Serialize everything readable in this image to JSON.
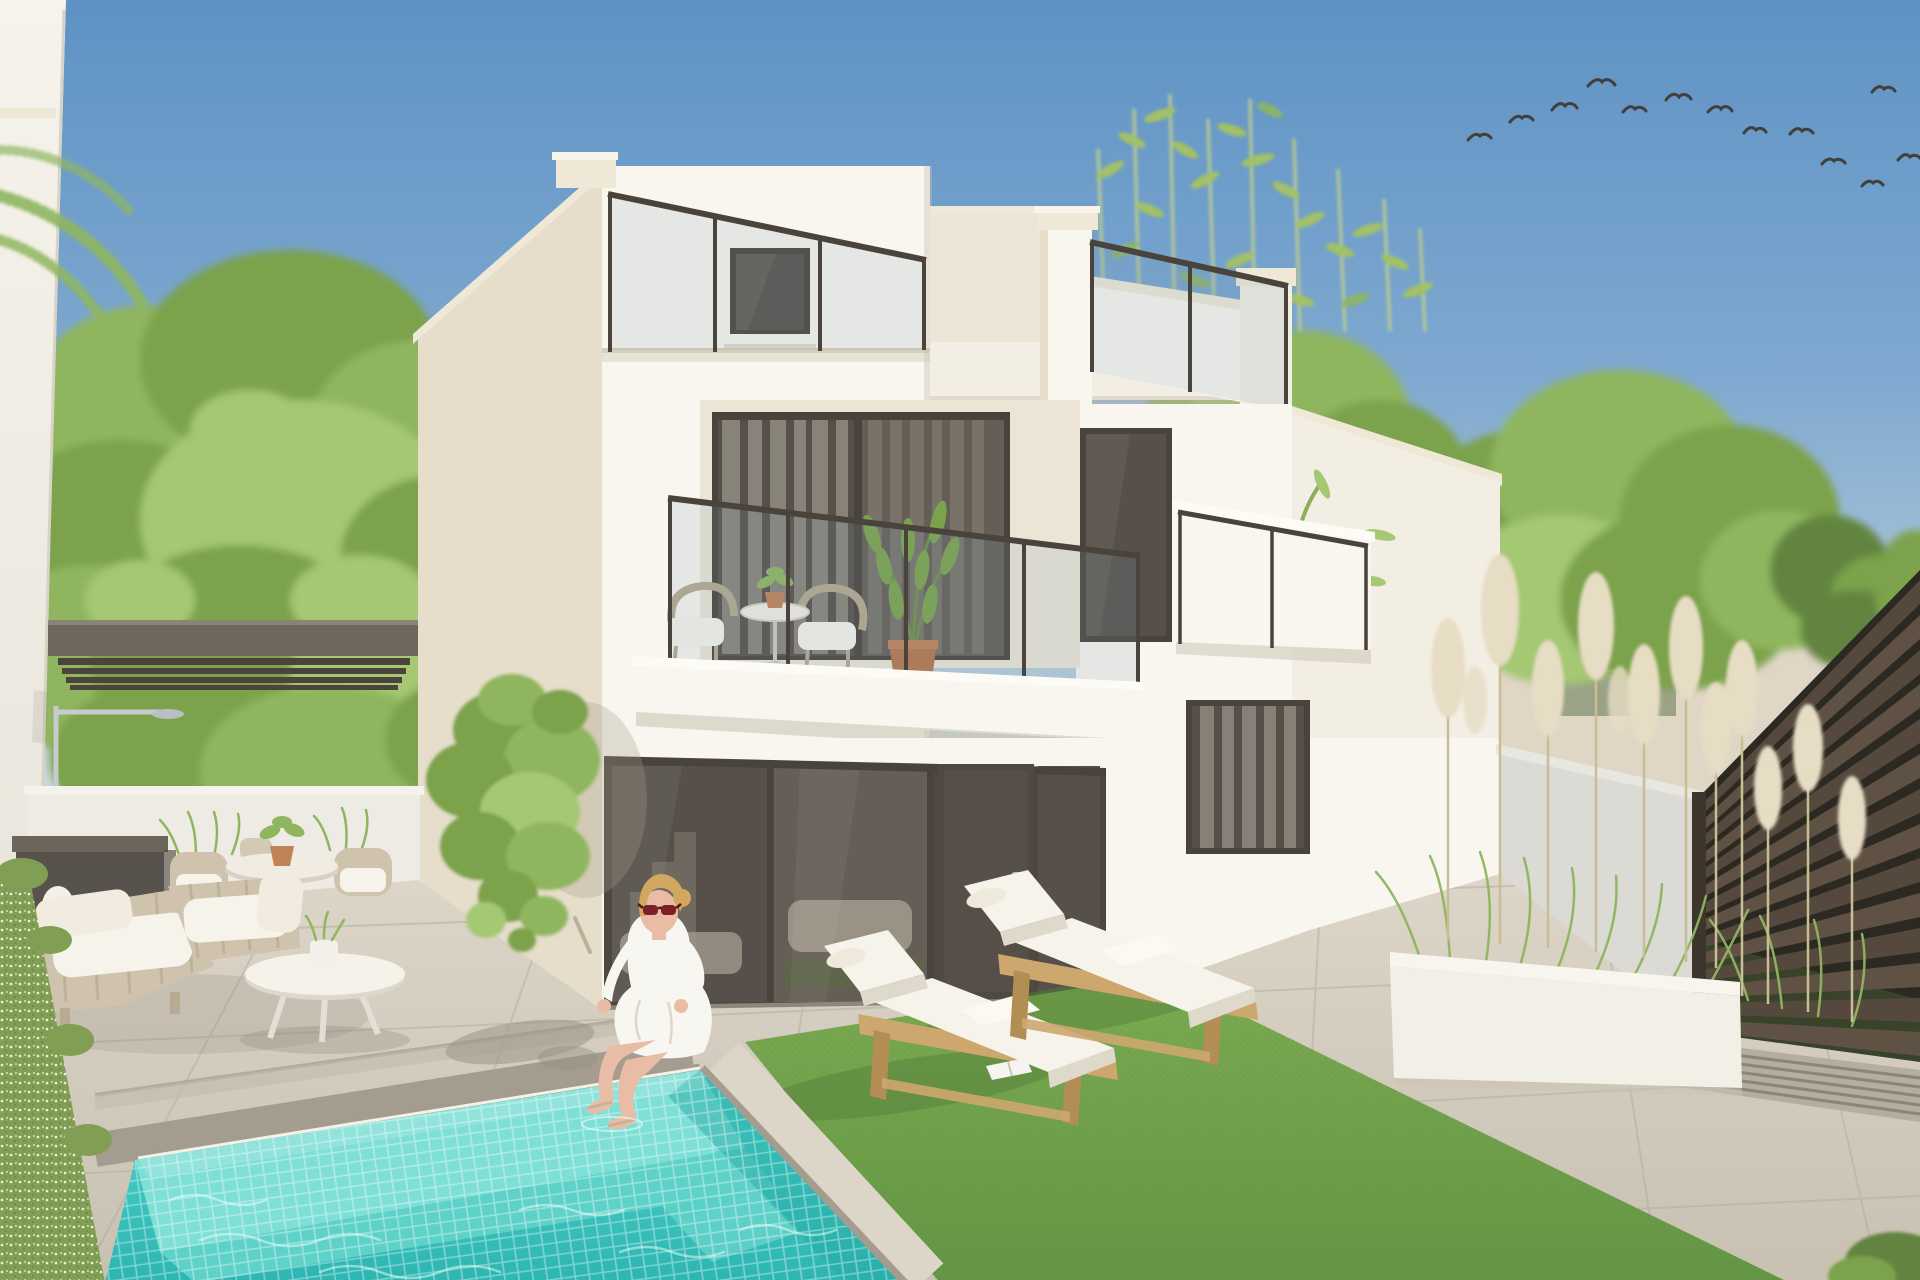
{
  "image": {
    "type": "photorealistic architectural exterior render",
    "description": "Modern white two-storey villa with rooftop terraces and glass railings, first-floor balcony with bistro set, ground-floor glazing, turquoise mosaic swimming pool with steps, woman in white sitting on the pool edge, two wooden sun loungers with white cushions on artificial grass, outdoor lounge furniture under a dark pergola, climbing ivy, pampas-grass planter, dark slatted fence, green trees and a flock of birds in a clear blue sky."
  },
  "scene": {
    "sky": "clear blue, flock of birds upper right",
    "villa": [
      "left stair tower with small roof window",
      "rooftop glass railings",
      "bamboo on right roof terrace",
      "first-floor balcony with two wicker chairs, bistro table and potted plants",
      "dark-framed sliding glass doors",
      "dark entrance door",
      "right balcony with palm in white pot",
      "curtained windows"
    ],
    "garden": [
      "turquoise mosaic pool with tanning shelf and steps",
      "light stone patio tiles",
      "artificial grass",
      "two wooden sun loungers with white mattresses",
      "magazine on grass",
      "white oval coffee table",
      "rope-weave armchairs with white cushions",
      "round dining table with wicker chairs",
      "dark storage bench",
      "dark pergola with outdoor shower",
      "climbing ivy on wall",
      "flower hedge",
      "white planter with pampas grass",
      "dark horizontal slatted fence",
      "drainage grate"
    ],
    "people": [
      "blonde woman in white shirt and skirt with red sunglasses sitting at the pool corner, feet in the water"
    ]
  },
  "palette": {
    "sky_top": "#5e92c4",
    "sky_mid": "#7fa9d0",
    "sky_low": "#bacfdb",
    "sky_horizon": "#e4e4da",
    "house_white": "#f9f6f0",
    "house_white_warm": "#f3eee4",
    "house_cream": "#e6ddcb",
    "house_cap": "#efe8d7",
    "house_recess": "#ece5d6",
    "house_groove": "#d6cebc",
    "shadow_warm": "#c9c1b0",
    "frame_dark": "#4a433b",
    "glazing_dark": "#57504a",
    "glazing_dark2": "#655e56",
    "curtain": "#8e887e",
    "curtain2": "#7a746b",
    "rail_glass": "rgba(125,155,175,0.16)",
    "pergola": "#6f665c",
    "pergola_dark": "#4c443c",
    "wall_left": "#edebe4",
    "wall_right": "#dbdad5",
    "fence_bg": "#2c2822",
    "fence_slat": "#55493d",
    "fence_slat2": "#5f5244",
    "fence_post": "#3e362d",
    "distant_roof": "#b3866a",
    "distant_roof2": "#a87a5e",
    "distant_wall": "#e0d6c6",
    "distant_green": "#9aa386",
    "patio_hi": "#ddd6c9",
    "patio_lo": "#c8c1b2",
    "tile_line": "#b4ac9d",
    "coping": "#ddd6c8",
    "curb": "#a49c8e",
    "grate": "#b4ada0",
    "grate_line": "#8b8478",
    "grass_hi": "#7cab52",
    "grass_lo": "#639544",
    "grass_shadow": "#55803a",
    "pool_shelf": "#7edfd6",
    "pool_deep_hi": "#46ccc4",
    "pool_deep_lo": "#2db5b2",
    "pool_step": "#5ed2c8",
    "mosaic": "rgba(255,255,255,0.38)",
    "caustic": "#eafffa",
    "waterline": "#f4f1e6",
    "lounger_wood": "#cda76e",
    "lounger_wood_dark": "#b28e55",
    "cushion": "#f6f3ea",
    "cushion_shadow": "#dfd9cb",
    "planter": "#f2efe7",
    "pampas": "#e7dcc4",
    "pampas_stem": "#c9bd96",
    "hedge": "#819e55",
    "hedge_dot": "#f2efe0",
    "leaf1": "#7ba24c",
    "leaf2": "#8fb65f",
    "leaf3": "#a5c873",
    "leaf_dark": "#628441",
    "bamboo_leaf": "#a3c166",
    "bamboo_stem": "#bccd8e",
    "trunk": "#b3a58c",
    "skin": "#e9bda5",
    "hair": "#d2a75f",
    "glasses": "#7c1f27",
    "dress": "#f8f6f0",
    "bird": "#42403c",
    "chrome": "#c6cbce",
    "terracotta": "#c08257",
    "pot_white": "#f3f0e9",
    "wicker": "#cfc3ad",
    "wicker_line": "#b7a98e",
    "interior_sofa": "#a59d90",
    "interior_rug": "#5a6a40",
    "interior_stair": "#8d867a"
  }
}
